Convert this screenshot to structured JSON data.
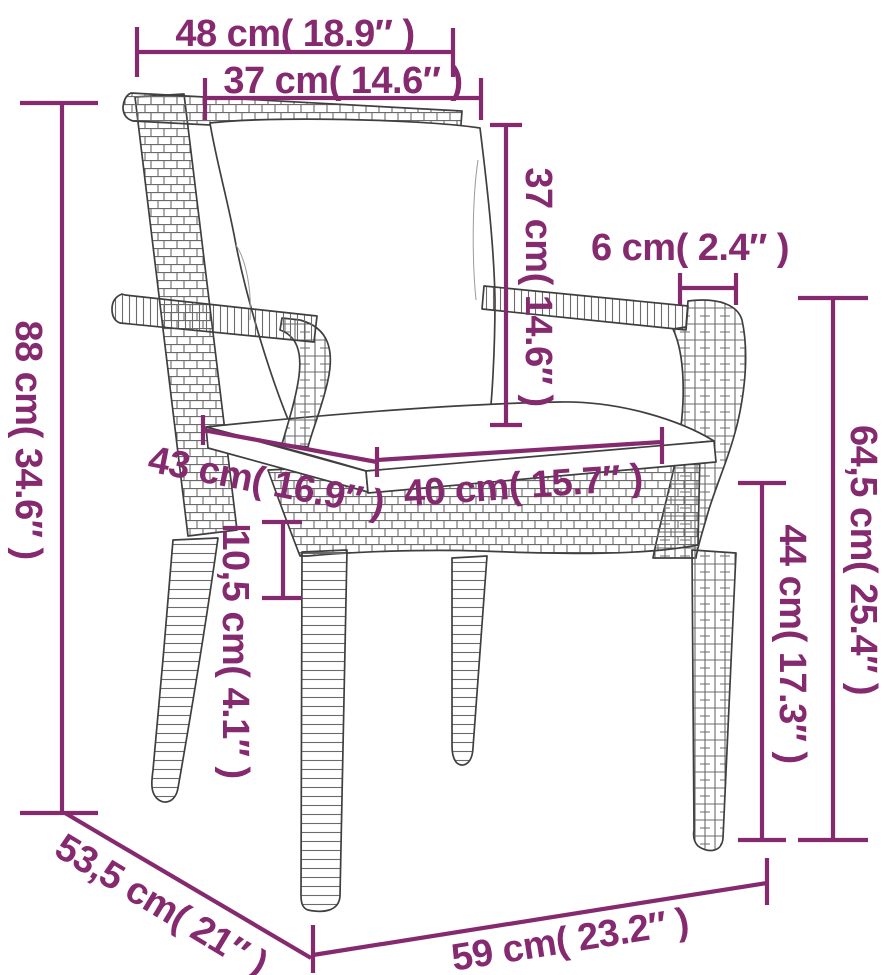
{
  "colors": {
    "accent": "#862a70",
    "line_art": "#3f3f3f",
    "background": "#ffffff"
  },
  "subject": "garden-chair-dimension-diagram",
  "measurements": [
    {
      "id": "top-rail-width",
      "cm": "48",
      "in": "18.9",
      "text": "48 cm( 18.9″ )"
    },
    {
      "id": "backrest-width",
      "cm": "37",
      "in": "14.6",
      "text": "37 cm( 14.6″ )"
    },
    {
      "id": "total-height",
      "cm": "88",
      "in": "34.6",
      "text": "88 cm( 34.6″ )"
    },
    {
      "id": "backrest-height",
      "cm": "37",
      "in": "14.6",
      "text": "37 cm( 14.6″ )"
    },
    {
      "id": "armrest-width",
      "cm": "6",
      "in": "2.4",
      "text": "6 cm( 2.4″ )"
    },
    {
      "id": "armrest-height",
      "cm": "64,5",
      "in": "25.4",
      "text": "64,5 cm( 25.4″ )"
    },
    {
      "id": "seat-height",
      "cm": "44",
      "in": "17.3",
      "text": "44 cm( 17.3″ )"
    },
    {
      "id": "seat-depth",
      "cm": "43",
      "in": "16.9",
      "text": "43 cm( 16.9″ )"
    },
    {
      "id": "seat-width",
      "cm": "40",
      "in": "15.7",
      "text": "40 cm( 15.7″ )"
    },
    {
      "id": "cushion-thickness",
      "cm": "10,5",
      "in": "4.1",
      "text": "10,5 cm( 4.1″ )"
    },
    {
      "id": "total-depth",
      "cm": "53,5",
      "in": "21",
      "text": "53,5 cm( 21″ )"
    },
    {
      "id": "total-width",
      "cm": "59",
      "in": "23.2",
      "text": "59 cm( 23.2″ )"
    }
  ]
}
